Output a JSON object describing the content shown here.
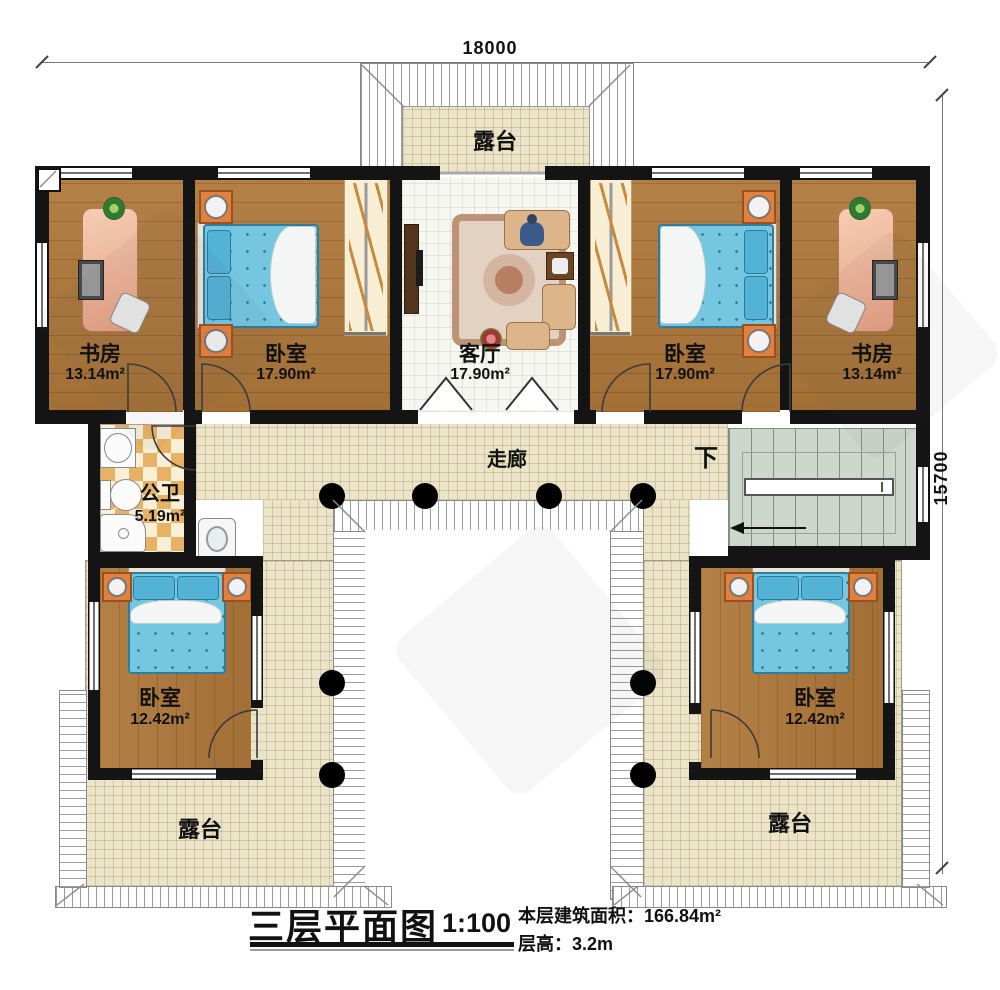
{
  "dimensions": {
    "top": "18000",
    "right": "15700"
  },
  "labels": {
    "terrace_top": "露台",
    "terrace_bottom_left": "露台",
    "terrace_bottom_right": "露台",
    "corridor": "走廊",
    "stairs_down": "下",
    "study_left": {
      "name": "书房",
      "area": "13.14m²"
    },
    "bedroom_upper_left": {
      "name": "卧室",
      "area": "17.90m²"
    },
    "living": {
      "name": "客厅",
      "area": "17.90m²"
    },
    "bedroom_upper_right": {
      "name": "卧室",
      "area": "17.90m²"
    },
    "study_right": {
      "name": "书房",
      "area": "13.14m²"
    },
    "bathroom": {
      "name": "公卫",
      "area": "5.19m²"
    },
    "bedroom_lower_left": {
      "name": "卧室",
      "area": "12.42m²"
    },
    "bedroom_lower_right": {
      "name": "卧室",
      "area": "12.42m²"
    }
  },
  "titleblock": {
    "title": "三层平面图",
    "scale": "1:100",
    "area_label": "本层建筑面积：",
    "area_value": "166.84m²",
    "floor_height_label": "层高：",
    "floor_height_value": "3.2m"
  }
}
